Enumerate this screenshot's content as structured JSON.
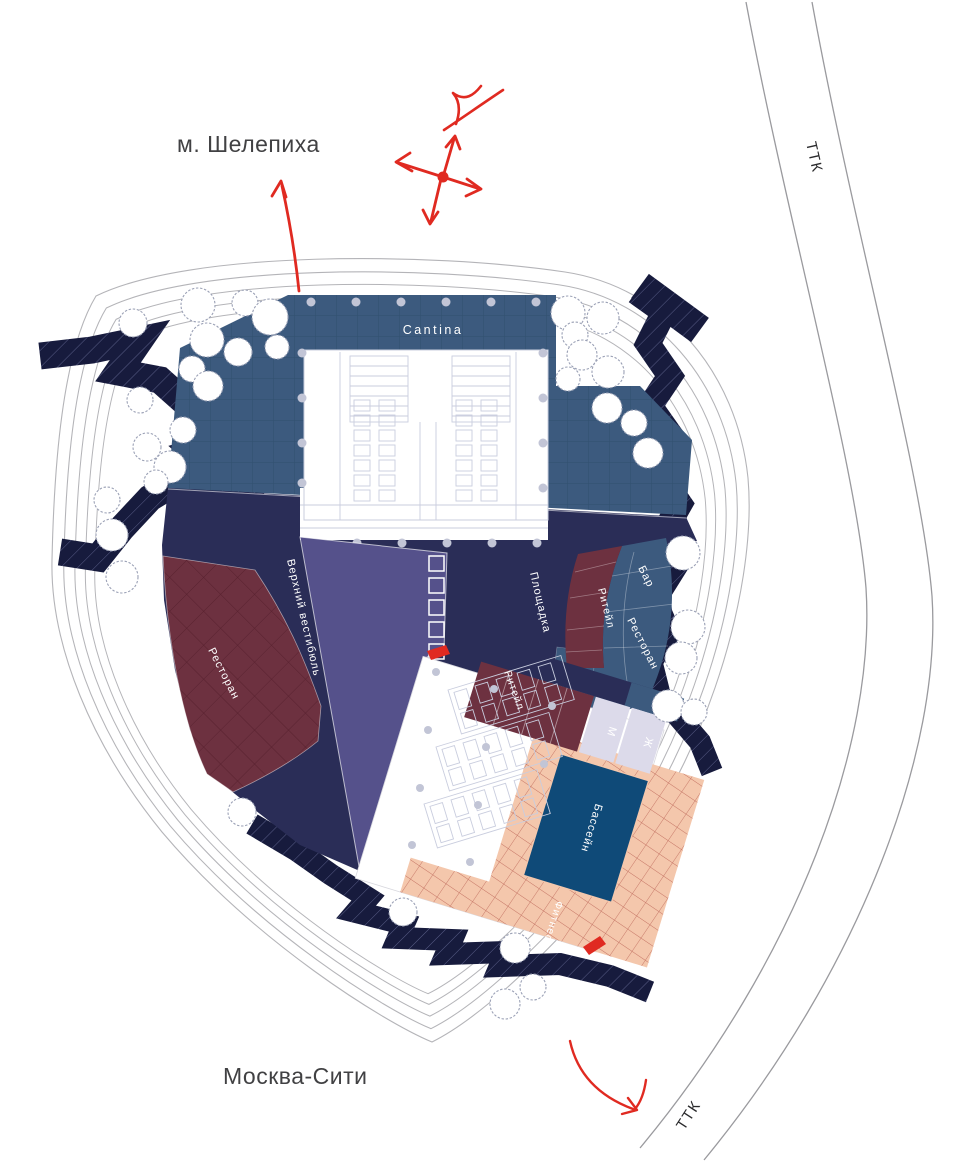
{
  "context_labels": {
    "metro": "м. Шелепиха",
    "city": "Москва-Сити",
    "ttk_top": "ТТК",
    "ttk_bottom": "ТТК"
  },
  "zones": {
    "cantina": "Cantina",
    "upper_vestibule": "Верхний вестибюль",
    "restaurant_west": "Ресторан",
    "event_area": "Площадка",
    "retail_arc": "Ритейл",
    "bar": "Бар",
    "restaurant_east": "Ресторан",
    "retail_pavilion": "Ритейл",
    "wc_men": "М",
    "wc_women": "Ж",
    "pool": "Бассейн",
    "fitness": "Фитнес"
  },
  "colors": {
    "terrace_blue": "#3c5a7e",
    "plaza_navy": "#2a2d57",
    "shadow_navy": "#171b3d",
    "wedge_purple": "#55518b",
    "zone_maroon": "#6d3140",
    "terrace_peach": "#f4c7ac",
    "pool_blue": "#0f4a78",
    "wc_lavender": "#dcdaea",
    "accent_red": "#e02a21",
    "contour_gray": "#b4b4b8",
    "text_gray": "#414143"
  }
}
